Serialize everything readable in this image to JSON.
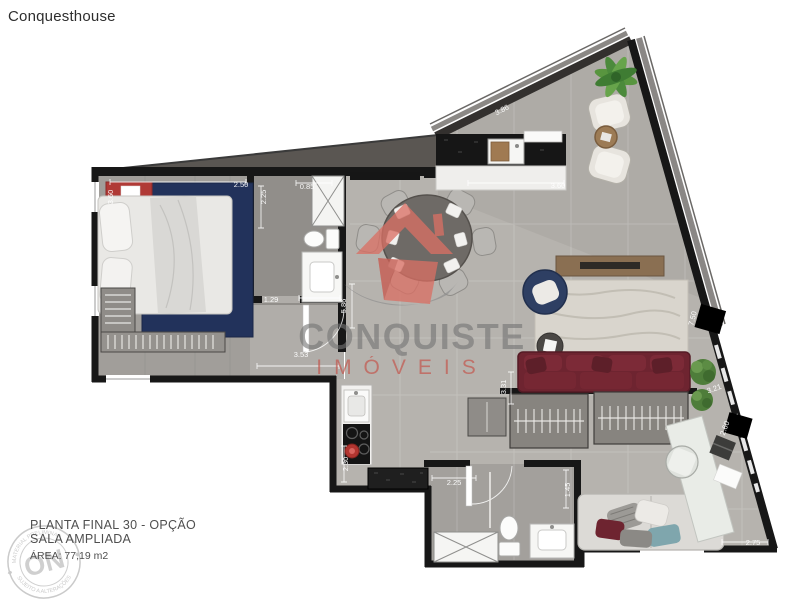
{
  "page": {
    "title": "Conquesthouse"
  },
  "caption": {
    "line1": "PLANTA FINAL 30 - OPÇÃO",
    "line2": "SALA AMPLIADA",
    "line3": "ÁREA: 77,19 m2"
  },
  "watermark": {
    "brand": "CONQUISTE",
    "brand_sub": "IMÓVEIS",
    "house_color": "#d96f64",
    "brand_color": "#757575",
    "sub_color": "#c4544b"
  },
  "stamp": {
    "center": "ON",
    "arc_top": "MATERIAL PRELIMINAR",
    "arc_bottom": "SUJEITO A ALTERAÇÕES"
  },
  "plan": {
    "wall_color": "#171717",
    "floor_color": "#b6b3ae",
    "bedroom_rug_color": "#22325b",
    "sofa_color": "#6e2430",
    "dimensions": [
      {
        "label": "3.60",
        "x": 113,
        "y": 197,
        "rot": -90
      },
      {
        "label": "2.50",
        "x": 241,
        "y": 187,
        "rot": 0
      },
      {
        "label": "2.25",
        "x": 266,
        "y": 197,
        "rot": -90
      },
      {
        "label": "0.85",
        "x": 307,
        "y": 189,
        "rot": 0
      },
      {
        "label": "3.86",
        "x": 503,
        "y": 112,
        "rot": -27
      },
      {
        "label": "3.60",
        "x": 558,
        "y": 188,
        "rot": 0
      },
      {
        "label": "1.29",
        "x": 271,
        "y": 302,
        "rot": 0
      },
      {
        "label": "5.86",
        "x": 346,
        "y": 306,
        "rot": -90
      },
      {
        "label": "3.53",
        "x": 301,
        "y": 357,
        "rot": 0
      },
      {
        "label": "2.30",
        "x": 348,
        "y": 464,
        "rot": -90
      },
      {
        "label": "2.25",
        "x": 454,
        "y": 485,
        "rot": 0
      },
      {
        "label": "1.45",
        "x": 570,
        "y": 490,
        "rot": -90
      },
      {
        "label": "3.31",
        "x": 506,
        "y": 387,
        "rot": -90
      },
      {
        "label": "7.50",
        "x": 695,
        "y": 319,
        "rot": -75
      },
      {
        "label": "3.21",
        "x": 715,
        "y": 391,
        "rot": -20
      },
      {
        "label": "2.60",
        "x": 727,
        "y": 429,
        "rot": -70
      },
      {
        "label": "2.75",
        "x": 753,
        "y": 545,
        "rot": 0
      }
    ]
  }
}
